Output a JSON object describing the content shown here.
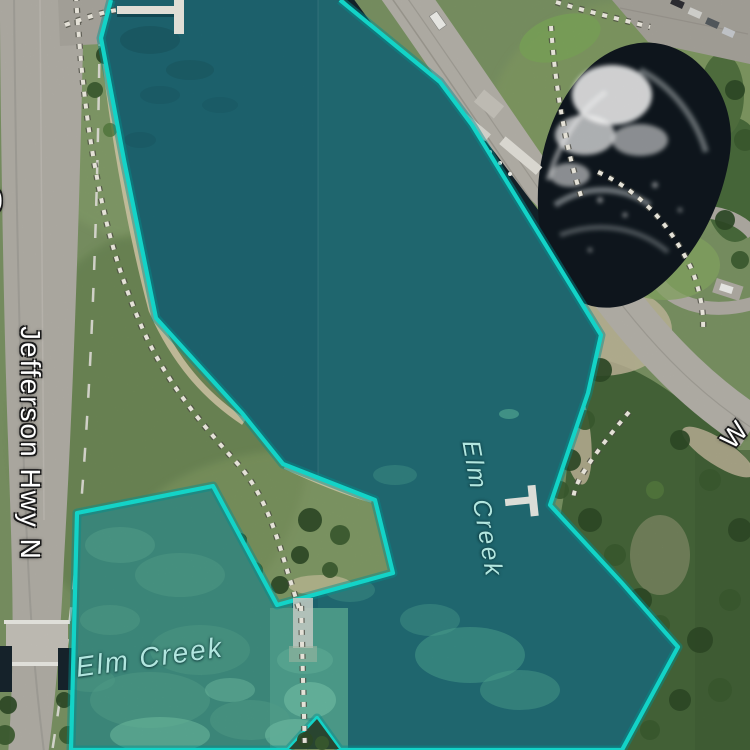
{
  "map": {
    "view_type": "satellite",
    "labels": {
      "highway": "Jefferson Hwy N",
      "water_upper": "Elm Creek",
      "water_lower": "Elm Creek",
      "road_right_partial": "W",
      "road_left_partial": "0"
    },
    "selection": {
      "feature_name": "Elm Creek",
      "outline_color": "#15e0d3",
      "glow_color": "rgba(0,150,150,0.45)",
      "water_tint": "#216c75"
    },
    "label_color_water": "#b2e6df",
    "label_color_road": "#ffffff"
  }
}
